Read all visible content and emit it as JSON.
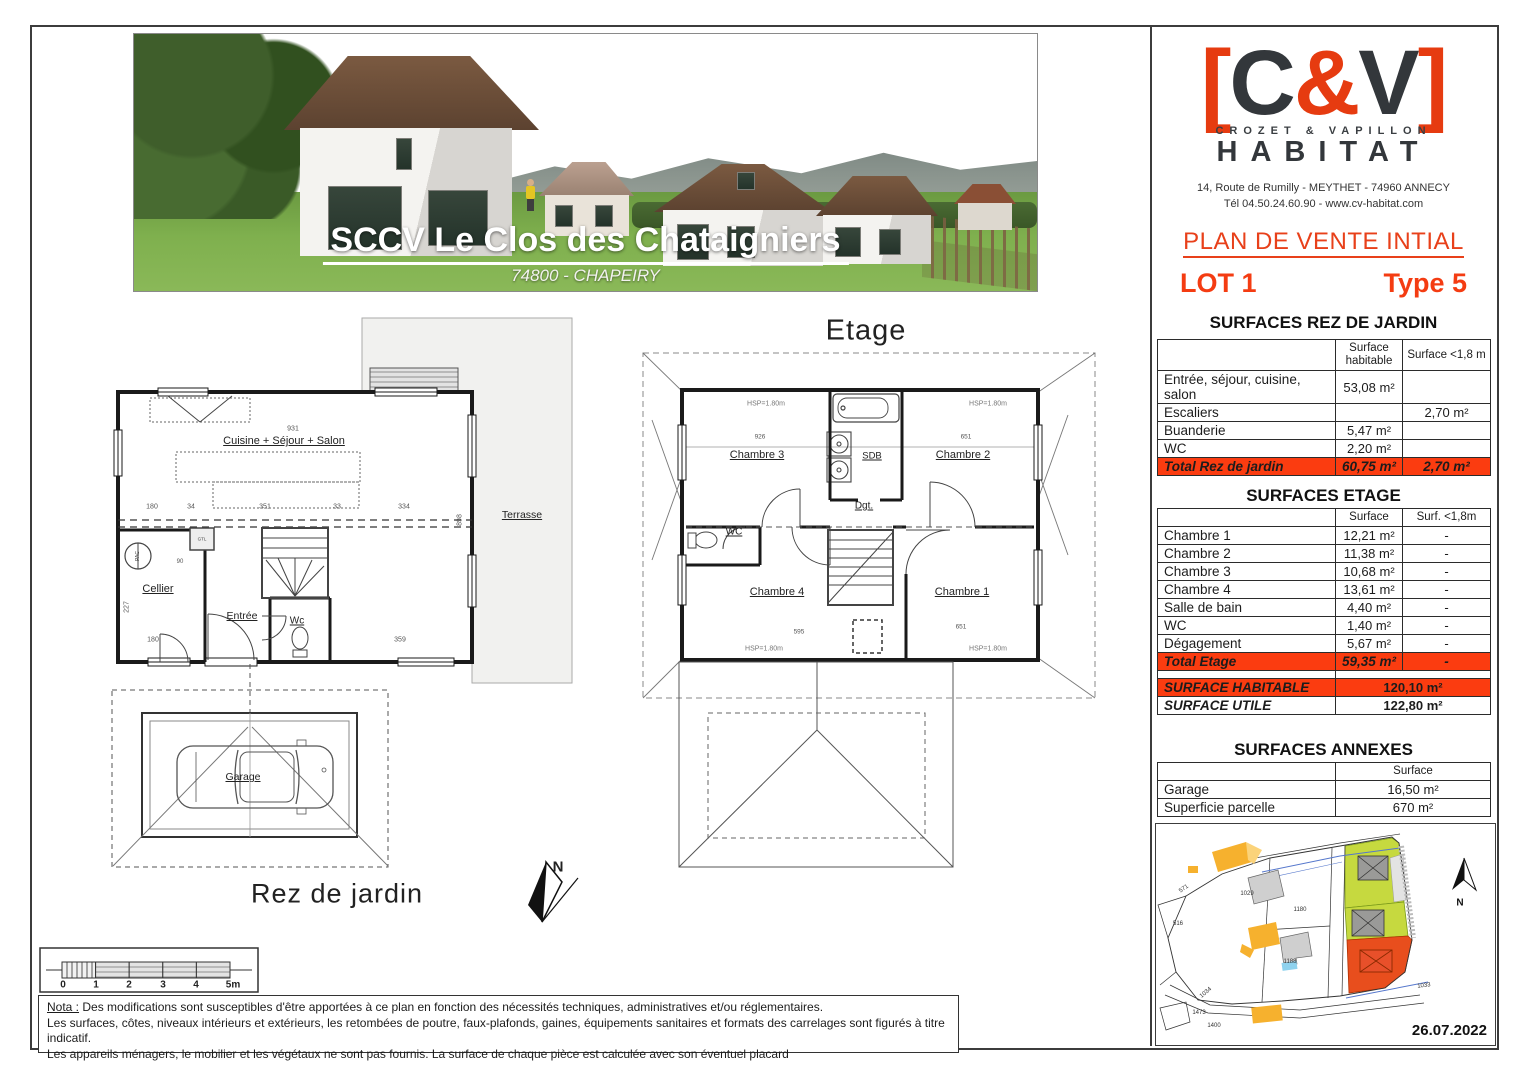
{
  "banner": {
    "title": "SCCV Le Clos des Chataigniers",
    "subtitle": "74800 - CHAPEIRY"
  },
  "logo": {
    "lb": "[",
    "c": "C",
    "amp": "&",
    "v": "V",
    "rb": "]",
    "tagline": "CROZET & VAPILLON",
    "name": "HABITAT",
    "address": "14, Route de Rumilly - MEYTHET - 74960 ANNECY",
    "contact": "Tél 04.50.24.60.90 - www.cv-habitat.com"
  },
  "header": {
    "title": "PLAN DE VENTE INTIAL",
    "lot": "LOT 1",
    "type": "Type 5"
  },
  "surfaces_rdj": {
    "title": "SURFACES REZ DE JARDIN",
    "col_surface": "Surface habitable",
    "col_lt18": "Surface <1,8 m",
    "rows": [
      {
        "label": "Entrée, séjour, cuisine, salon",
        "surface": "53,08 m²",
        "lt18": ""
      },
      {
        "label": "Escaliers",
        "surface": "",
        "lt18": "2,70 m²"
      },
      {
        "label": "Buanderie",
        "surface": "5,47 m²",
        "lt18": ""
      },
      {
        "label": "WC",
        "surface": "2,20 m²",
        "lt18": ""
      }
    ],
    "total": {
      "label": "Total Rez de jardin",
      "surface": "60,75 m²",
      "lt18": "2,70 m²"
    }
  },
  "surfaces_etage": {
    "title": "SURFACES ETAGE",
    "col_surface": "Surface",
    "col_lt18": "Surf. <1,8m",
    "rows": [
      {
        "label": "Chambre 1",
        "surface": "12,21 m²",
        "lt18": "-"
      },
      {
        "label": "Chambre 2",
        "surface": "11,38 m²",
        "lt18": "-"
      },
      {
        "label": "Chambre 3",
        "surface": "10,68 m²",
        "lt18": "-"
      },
      {
        "label": "Chambre 4",
        "surface": "13,61 m²",
        "lt18": "-"
      },
      {
        "label": "Salle de bain",
        "surface": "4,40 m²",
        "lt18": "-"
      },
      {
        "label": "WC",
        "surface": "1,40 m²",
        "lt18": "-"
      },
      {
        "label": "Dégagement",
        "surface": "5,67 m²",
        "lt18": "-"
      }
    ],
    "total": {
      "label": "Total Etage",
      "surface": "59,35 m²",
      "lt18": "-"
    }
  },
  "summary": {
    "habitable": {
      "label": "SURFACE HABITABLE",
      "value": "120,10 m²"
    },
    "utile": {
      "label": "SURFACE UTILE",
      "value": "122,80 m²"
    }
  },
  "surfaces_annexes": {
    "title": "SURFACES ANNEXES",
    "col_surface": "Surface",
    "rows": [
      {
        "label": "Garage",
        "value": "16,50 m²"
      },
      {
        "label": "Superficie parcelle",
        "value": "670 m²"
      }
    ]
  },
  "plan_etage": {
    "title": "Etage",
    "rooms": {
      "chambre3": "Chambre 3",
      "sdb": "SDB",
      "chambre2": "Chambre 2",
      "dgt": "Dgt.",
      "wc": "WC",
      "chambre4": "Chambre 4",
      "chambre1": "Chambre 1"
    },
    "hsp": "HSP=1.80m",
    "dims": {
      "d926": "926",
      "d651a": "651",
      "d595": "595",
      "d651b": "651"
    }
  },
  "plan_rdj": {
    "label": "Rez de jardin",
    "rooms": {
      "cuisine": "Cuisine + Séjour + Salon",
      "cellier": "Cellier",
      "entree": "Entrée",
      "wc": "Wc",
      "terrasse": "Terrasse",
      "garage": "Garage",
      "pac": "PAC",
      "gtl": "GTL"
    },
    "dims": {
      "d931": "931",
      "d180a": "180",
      "d34": "34",
      "d351": "351",
      "d33": "33",
      "d334": "334",
      "d90": "90",
      "d227": "227",
      "d180b": "180",
      "d359": "359",
      "d898": "898"
    }
  },
  "north": "N",
  "scalebar": {
    "ticks": [
      "0",
      "1",
      "2",
      "3",
      "4",
      "5m"
    ]
  },
  "nota": {
    "label": "Nota :",
    "line1": " Des modifications sont susceptibles d'être apportées à ce plan en fonction des nécessités techniques, administratives et/ou réglementaires.",
    "line2": "Les surfaces, côtes, niveaux intérieurs et extérieurs, les retombées de poutre, faux-plafonds, gaines, équipements sanitaires et formats des carrelages sont figurés à titre indicatif.",
    "line3": "Les appareils ménagers, le mobilier et les végétaux ne sont pas fournis. La surface de chaque pièce est calculée avec son éventuel placard"
  },
  "siteplan": {
    "parcels": [
      "571",
      "516",
      "1029",
      "1180",
      "1188",
      "1033",
      "1034",
      "1473",
      "1400"
    ],
    "north": "N",
    "date": "26.07.2022"
  },
  "colors": {
    "accent": "#fb3c10",
    "logo_red": "#e63b10",
    "logo_dark": "#33373b"
  }
}
